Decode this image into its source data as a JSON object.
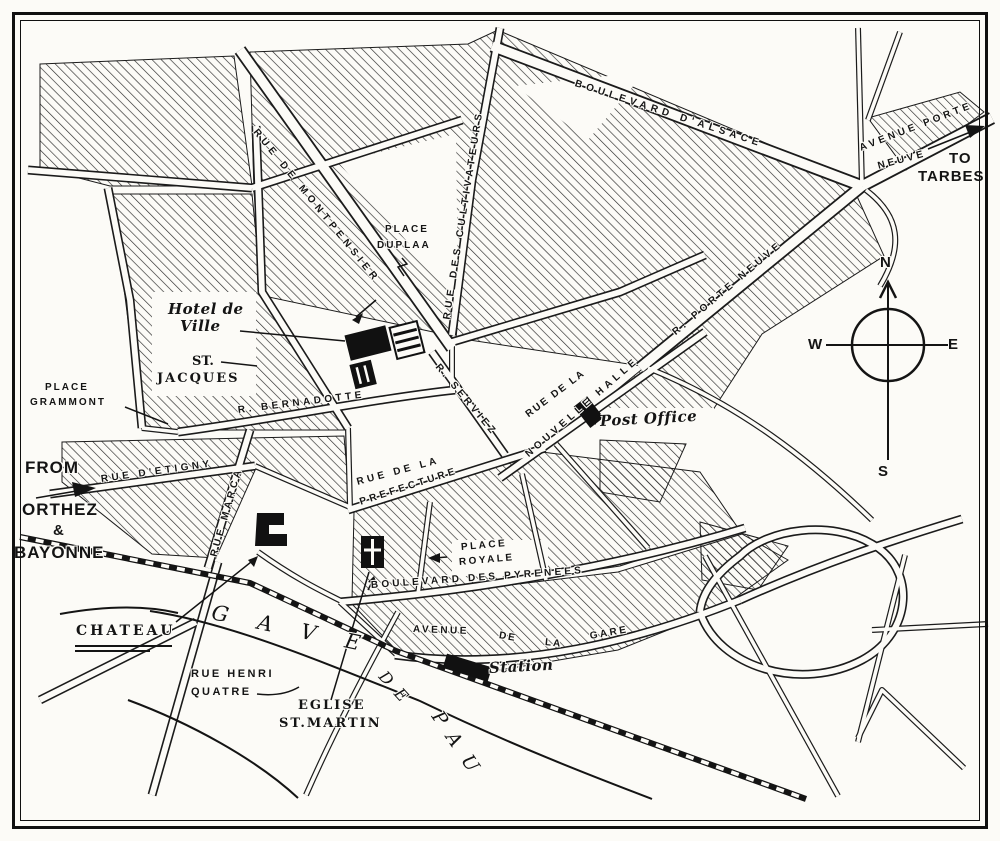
{
  "map_title": "Street plan of Pau",
  "colors": {
    "ink": "#1b1b1b",
    "paper": "#fcfbf7"
  },
  "labels": [
    {
      "id": "boulevard-dalsace",
      "t": "BOULEVARD D'ALSACE",
      "x": 575,
      "y": 78,
      "r": 18,
      "c": "s",
      "ls": 4.5
    },
    {
      "id": "avenue-porte",
      "t": "AVENUE PORTE",
      "x": 860,
      "y": 143,
      "r": -21,
      "c": "s",
      "ls": 3.5
    },
    {
      "id": "avenue-neuve",
      "t": "NEUVE",
      "x": 878,
      "y": 161,
      "r": -15,
      "c": "s",
      "ls": 3
    },
    {
      "id": "to",
      "t": "TO",
      "x": 949,
      "y": 150,
      "r": 0,
      "c": "b"
    },
    {
      "id": "tarbes",
      "t": "TARBES",
      "x": 918,
      "y": 168,
      "r": 0,
      "c": "b"
    },
    {
      "id": "rue-de-montpensier",
      "t": "RUE DE MONTPENSIER",
      "x": 255,
      "y": 125,
      "r": 51,
      "c": "s",
      "ls": 4.5
    },
    {
      "id": "place-duplaa-1",
      "t": "PLACE",
      "x": 385,
      "y": 224,
      "r": 0,
      "c": "s",
      "ls": 2
    },
    {
      "id": "place-duplaa-2",
      "t": "DUPLAA",
      "x": 377,
      "y": 240,
      "r": 0,
      "c": "s",
      "ls": 2
    },
    {
      "id": "rue-des-cultivateurs",
      "t": "RUE DES CULTIVATEURS",
      "x": 447,
      "y": 314,
      "r": -81,
      "c": "s",
      "ls": 4.5
    },
    {
      "id": "hotel-de-ville-1",
      "t": "Hotel de",
      "x": 168,
      "y": 300,
      "r": 0,
      "c": "it"
    },
    {
      "id": "hotel-de-ville-2",
      "t": "Ville",
      "x": 180,
      "y": 317,
      "r": 0,
      "c": "it"
    },
    {
      "id": "st-jacques-1",
      "t": "ST.",
      "x": 192,
      "y": 354,
      "r": 0,
      "c": "ser"
    },
    {
      "id": "st-jacques-2",
      "t": "JACQUES",
      "x": 157,
      "y": 371,
      "r": 0,
      "c": "ser",
      "ls": 2
    },
    {
      "id": "place-grammont-1",
      "t": "PLACE",
      "x": 45,
      "y": 382,
      "r": 0,
      "c": "s",
      "ls": 2
    },
    {
      "id": "place-grammont-2",
      "t": "GRAMMONT",
      "x": 30,
      "y": 397,
      "r": 0,
      "c": "s",
      "ls": 2
    },
    {
      "id": "r-bernadotte",
      "t": "R. BERNADOTTE",
      "x": 238,
      "y": 405,
      "r": -7,
      "c": "s",
      "ls": 3.5
    },
    {
      "id": "r-serviez",
      "t": "R. SERVIEZ",
      "x": 437,
      "y": 360,
      "r": 50,
      "c": "s",
      "ls": 3.5
    },
    {
      "id": "rue-de-la-nouvelle-halle-1",
      "t": "RUE DE LA",
      "x": 527,
      "y": 410,
      "r": -37,
      "c": "s",
      "ls": 2
    },
    {
      "id": "rue-de-la-nouvelle-halle-2",
      "t": "NOUVELLE HALLE",
      "x": 527,
      "y": 450,
      "r": -41,
      "c": "s",
      "ls": 4
    },
    {
      "id": "r-porte-neuve",
      "t": "R. PORTE NEUVE",
      "x": 674,
      "y": 328,
      "r": -40,
      "c": "s",
      "ls": 4
    },
    {
      "id": "post-office",
      "t": "Post Office",
      "x": 600,
      "y": 412,
      "r": -3,
      "c": "it"
    },
    {
      "id": "rue-de-la-prefecture-1",
      "t": "RUE DE LA",
      "x": 357,
      "y": 477,
      "r": -15,
      "c": "s",
      "ls": 3.5
    },
    {
      "id": "rue-de-la-prefecture-2",
      "t": "PREFECTURE",
      "x": 360,
      "y": 497,
      "r": -18,
      "c": "s",
      "ls": 3.5
    },
    {
      "id": "from",
      "t": "FROM",
      "x": 25,
      "y": 458,
      "r": 0,
      "c": "b",
      "fs": 17
    },
    {
      "id": "orthez",
      "t": "ORTHEZ",
      "x": 22,
      "y": 500,
      "r": 0,
      "c": "b",
      "fs": 17
    },
    {
      "id": "ampersand",
      "t": "&",
      "x": 53,
      "y": 522,
      "r": 0,
      "c": "b",
      "fs": 15
    },
    {
      "id": "bayonne",
      "t": "BAYONNE",
      "x": 14,
      "y": 543,
      "r": 0,
      "c": "b",
      "fs": 17
    },
    {
      "id": "rue-detigny",
      "t": "RUE D'ETIGNY",
      "x": 101,
      "y": 474,
      "r": -8,
      "c": "s",
      "ls": 3.5
    },
    {
      "id": "rue-marca",
      "t": "RUE MARCA",
      "x": 214,
      "y": 551,
      "r": -74,
      "c": "s",
      "ls": 3.5
    },
    {
      "id": "place-royale-1",
      "t": "PLACE",
      "x": 461,
      "y": 542,
      "r": -5,
      "c": "s",
      "ls": 2.5
    },
    {
      "id": "place-royale-2",
      "t": "ROYALE",
      "x": 459,
      "y": 557,
      "r": -5,
      "c": "s",
      "ls": 2.5
    },
    {
      "id": "boulevard-des-pyrenees",
      "t": "BOULEVARD DES PYRENEES",
      "x": 371,
      "y": 580,
      "r": -4,
      "c": "s",
      "ls": 3.2
    },
    {
      "id": "chateau",
      "t": "CHATEAU",
      "x": 76,
      "y": 623,
      "r": 0,
      "c": "ser",
      "ls": 3,
      "fs": 14
    },
    {
      "id": "gave",
      "t": "GAVE",
      "x": 212,
      "y": 600,
      "r": 12,
      "c": "riv",
      "ls": 30
    },
    {
      "id": "de",
      "t": "DE",
      "x": 382,
      "y": 664,
      "r": 48,
      "c": "riv",
      "fs": 16,
      "ls": 10
    },
    {
      "id": "pau",
      "t": "PAU",
      "x": 436,
      "y": 702,
      "r": 56,
      "c": "riv",
      "fs": 19,
      "ls": 14
    },
    {
      "id": "avenue-de-la-gare-1",
      "t": "AVENUE",
      "x": 413,
      "y": 624,
      "r": 2,
      "c": "s",
      "ls": 2.5
    },
    {
      "id": "avenue-de-la-gare-2",
      "t": "DE",
      "x": 499,
      "y": 630,
      "r": 10,
      "c": "s",
      "ls": 2
    },
    {
      "id": "avenue-de-la-gare-3",
      "t": "LA",
      "x": 545,
      "y": 637,
      "r": 6,
      "c": "s",
      "ls": 2
    },
    {
      "id": "avenue-de-la-gare-4",
      "t": "GARE",
      "x": 590,
      "y": 631,
      "r": -10,
      "c": "s",
      "ls": 2.5
    },
    {
      "id": "station",
      "t": "Station",
      "x": 489,
      "y": 659,
      "r": -3,
      "c": "it"
    },
    {
      "id": "rue-henri-quatre-1",
      "t": "RUE HENRI",
      "x": 191,
      "y": 668,
      "r": 0,
      "c": "s",
      "ls": 2.5,
      "fs": 11
    },
    {
      "id": "rue-henri-quatre-2",
      "t": "QUATRE",
      "x": 191,
      "y": 686,
      "r": 0,
      "c": "s",
      "ls": 2.5,
      "fs": 11
    },
    {
      "id": "eglise-st-martin-1",
      "t": "EGLISE",
      "x": 298,
      "y": 698,
      "r": 0,
      "c": "ser",
      "ls": 2
    },
    {
      "id": "eglise-st-martin-2",
      "t": "ST.MARTIN",
      "x": 279,
      "y": 716,
      "r": 0,
      "c": "ser",
      "ls": 2
    },
    {
      "id": "compass-n",
      "t": "N",
      "x": 880,
      "y": 254,
      "r": 0,
      "c": "b"
    },
    {
      "id": "compass-w",
      "t": "W",
      "x": 808,
      "y": 336,
      "r": 0,
      "c": "b"
    },
    {
      "id": "compass-e",
      "t": "E",
      "x": 948,
      "y": 336,
      "r": 0,
      "c": "b"
    },
    {
      "id": "compass-s",
      "t": "S",
      "x": 878,
      "y": 463,
      "r": 0,
      "c": "b"
    }
  ]
}
